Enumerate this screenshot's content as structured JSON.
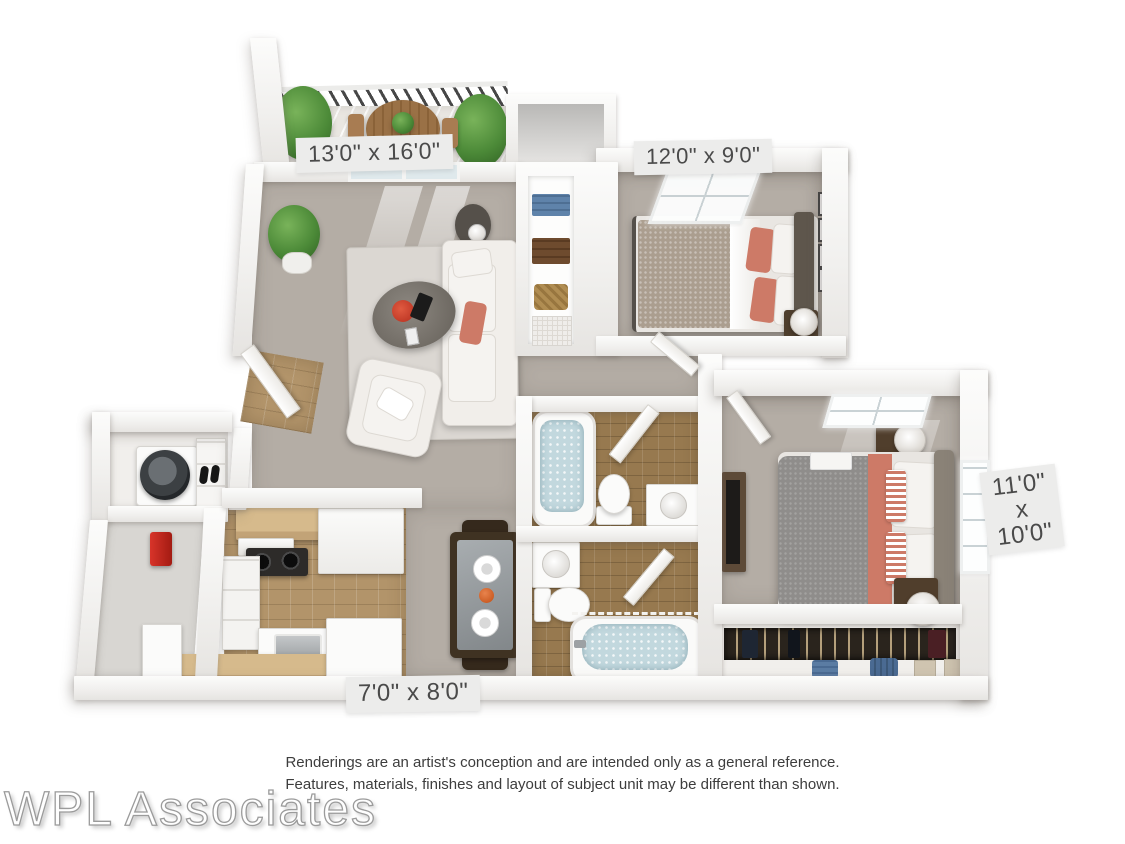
{
  "floorplan": {
    "labels": {
      "living_room": "13'0\" x 16'0\"",
      "bedroom_small": "12'0\" x 9'0\"",
      "bedroom_master": {
        "line1": "11'0\"",
        "line2": "x",
        "line3": "10'0\""
      },
      "kitchen": "7'0\" x 8'0\""
    },
    "colors": {
      "floor": "#b4ada5",
      "rug": "#dbd7d2",
      "tile-kitchen": "#b2946a",
      "tile-bath": "#97794f",
      "wood": "#d6ba8c",
      "wood-dark": "#9a7146",
      "furniture-dark": "#4e3e2d",
      "coral": "#cd7a67",
      "plant": "#4c8a38",
      "water": "#c2d8de",
      "bed-gray": "#8f8d8b",
      "bed-tan": "#ab9e8f",
      "label-bg": "#ececeb",
      "label-text": "#4a4a4a",
      "text": "#3d3d3d",
      "watermark": "#9b9b9b"
    }
  },
  "disclaimer": {
    "line1": "Renderings are an artist's conception and are intended only as a general reference.",
    "line2": "Features, materials, finishes and layout of subject unit may be different than shown."
  },
  "watermark": "WPL Associates"
}
